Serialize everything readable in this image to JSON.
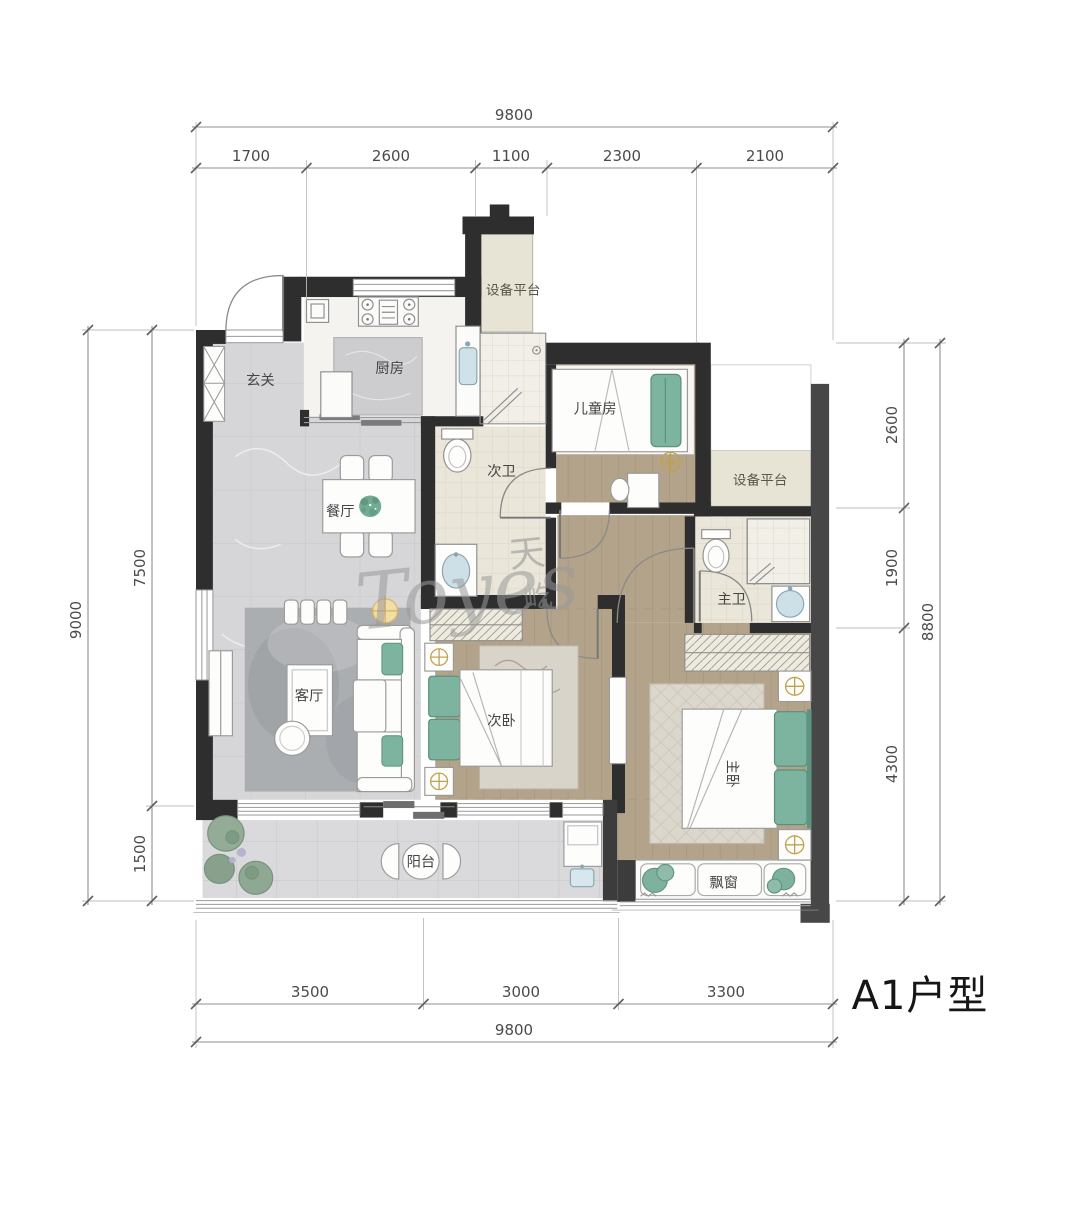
{
  "title": "A1户型",
  "watermark": {
    "script": "Toyes",
    "char1": "天",
    "char2": "屹"
  },
  "rooms": {
    "entry": "玄关",
    "kitchen": "厨房",
    "equip_top": "设备平台",
    "kids": "儿童房",
    "bath2": "次卫",
    "dining": "餐厅",
    "equip_right": "设备平台",
    "bath1": "主卫",
    "living": "客厅",
    "bed2": "次卧",
    "bed1": "主卧",
    "balcony": "阳台",
    "bay": "飘窗"
  },
  "dims": {
    "top_total": "9800",
    "top_segs": [
      "1700",
      "2600",
      "1100",
      "2300",
      "2100"
    ],
    "left_total": "9000",
    "left_segs": [
      "7500",
      "1500"
    ],
    "right_total": "8800",
    "right_segs": [
      "2600",
      "1900",
      "4300"
    ],
    "bottom_total": "9800",
    "bottom_segs": [
      "3500",
      "3000",
      "3300"
    ]
  }
}
